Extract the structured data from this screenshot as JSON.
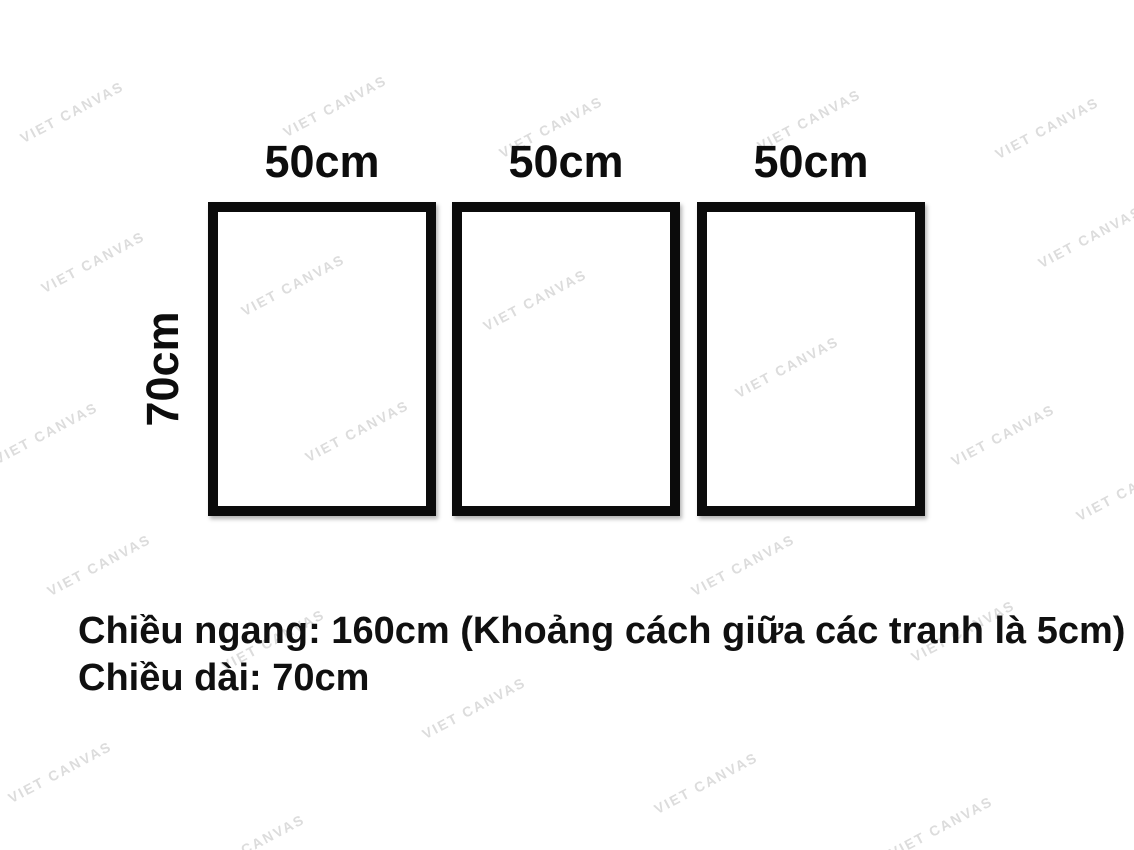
{
  "watermark": {
    "text": "VIET CANVAS",
    "color": "#dcdcdc",
    "positions": [
      [
        72,
        112
      ],
      [
        335,
        106
      ],
      [
        551,
        127
      ],
      [
        809,
        120
      ],
      [
        1047,
        128
      ],
      [
        1090,
        237
      ],
      [
        93,
        262
      ],
      [
        293,
        285
      ],
      [
        535,
        300
      ],
      [
        46,
        433
      ],
      [
        357,
        431
      ],
      [
        787,
        367
      ],
      [
        1003,
        435
      ],
      [
        1128,
        490
      ],
      [
        99,
        565
      ],
      [
        743,
        565
      ],
      [
        273,
        640
      ],
      [
        963,
        631
      ],
      [
        474,
        708
      ],
      [
        60,
        772
      ],
      [
        706,
        783
      ],
      [
        253,
        845
      ],
      [
        941,
        827
      ]
    ]
  },
  "frames": [
    {
      "width_label": "50cm"
    },
    {
      "width_label": "50cm"
    },
    {
      "width_label": "50cm"
    }
  ],
  "height_label": "70cm",
  "note": {
    "line1": "Chiều ngang: 160cm (Khoảng cách giữa các tranh là 5cm)",
    "line2": "Chiều dài: 70cm"
  },
  "colors": {
    "background": "#ffffff",
    "frame_border": "#0b0b0b",
    "text": "#0d0d0d",
    "watermark": "#dcdcdc"
  }
}
